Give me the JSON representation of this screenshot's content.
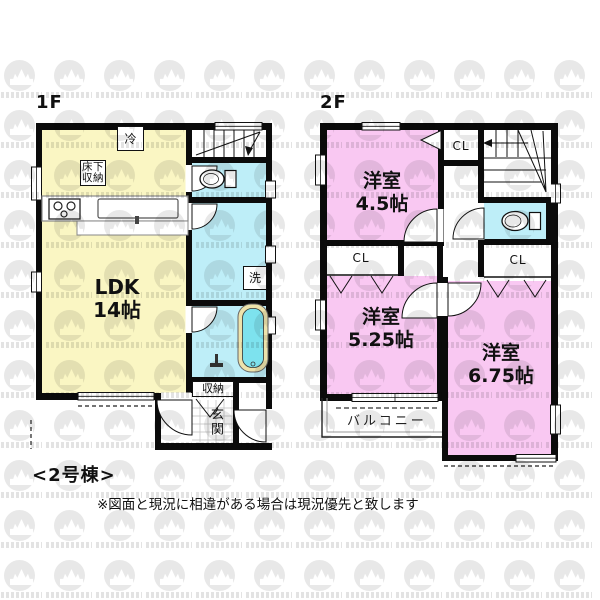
{
  "floor1": {
    "label": "1F",
    "ldk_name": "LDK",
    "ldk_size": "14帖",
    "fridge": "冷",
    "underfloor_storage": "床下収納",
    "laundry": "洗",
    "storage": "収納",
    "entrance": "玄関"
  },
  "floor2": {
    "label": "2F",
    "room1_name": "洋室",
    "room1_size": "4.5帖",
    "room2_name": "洋室",
    "room2_size": "5.25帖",
    "room3_name": "洋室",
    "room3_size": "6.75帖",
    "closet1": "CL",
    "closet2": "CL",
    "closet3": "CL",
    "balcony": "バルコニー"
  },
  "footer": {
    "unit_label": "<2号棟>",
    "disclaimer": "※図面と現況に相違がある場合は現況優先と致します"
  },
  "colors": {
    "ldk": "#FAF6C3",
    "western_room": "#F9C8F2",
    "wet_room": "#BEEEF8",
    "bathtub": "#7DE2EE",
    "wall": "#0B0B0B",
    "watermark": "#E8E8E8"
  }
}
